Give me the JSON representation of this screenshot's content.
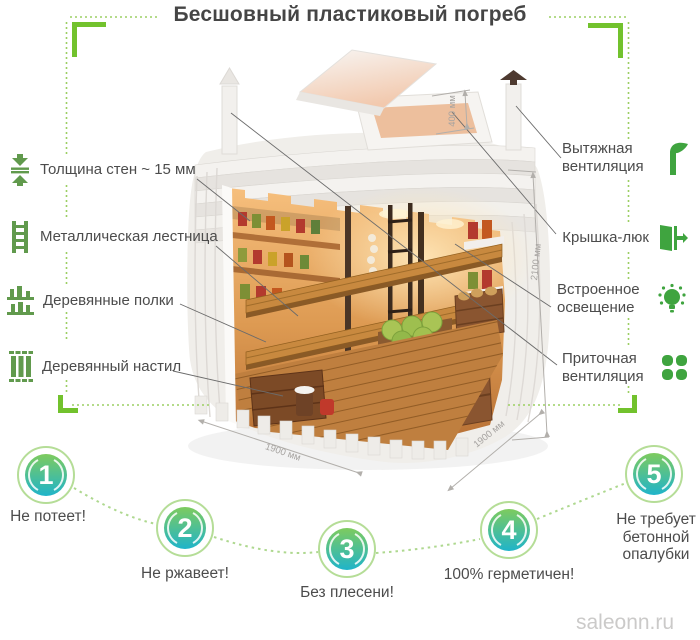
{
  "title": "Бесшовный пластиковый погреб",
  "watermark": "saleonn.ru",
  "accent_colors": {
    "green_solid": "#72c22d",
    "green_dotted": "#9ccf63",
    "badge_gradient_top": "#7ecb5e",
    "badge_gradient_bottom": "#1fb4ca",
    "text": "#4c4c4c"
  },
  "left_labels": [
    {
      "label": "Толщина стен ~ 15 мм",
      "icon": "wall-thickness-icon"
    },
    {
      "label": "Металлическая лестница",
      "icon": "metal-ladder-icon"
    },
    {
      "label": "Деревянные полки",
      "icon": "wooden-shelves-icon"
    },
    {
      "label": "Деревянный настил",
      "icon": "wooden-deck-icon"
    }
  ],
  "right_labels": [
    {
      "label": "Вытяжная вентиляция",
      "icon": "exhaust-vent-icon"
    },
    {
      "label": "Крышка-люк",
      "icon": "hatch-lid-icon"
    },
    {
      "label": "Встроенное освещение",
      "icon": "built-in-light-icon"
    },
    {
      "label": "Приточная вентиляция",
      "icon": "supply-vent-icon"
    }
  ],
  "dimensions": {
    "hatch_height": "400 мм",
    "inner_height": "2100 мм",
    "depth": "1900 мм",
    "width": "1900 мм"
  },
  "benefits": [
    {
      "number": "1",
      "label": "Не потеет!"
    },
    {
      "number": "2",
      "label": "Не ржавеет!"
    },
    {
      "number": "3",
      "label": "Без плесени!"
    },
    {
      "number": "4",
      "label": "100% герметичен!"
    },
    {
      "number": "5",
      "label": "Не требует бетонной опалубки"
    }
  ]
}
